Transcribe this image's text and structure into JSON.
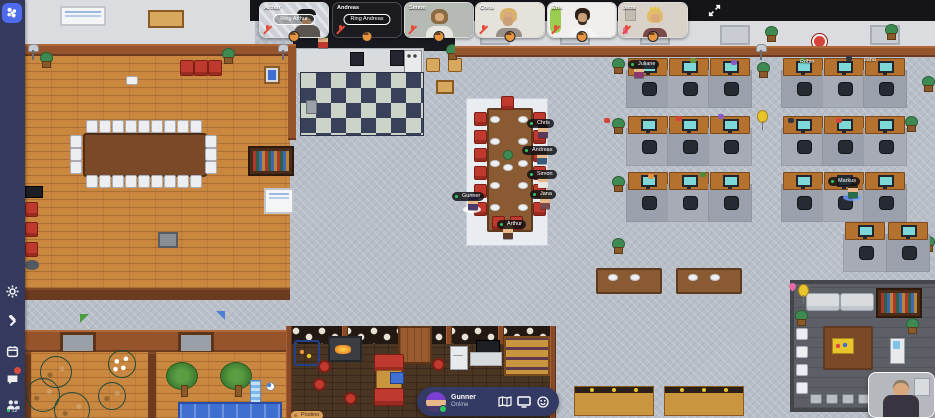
{
  "app": {
    "title": "Gather"
  },
  "sidebar": {
    "members_count": "12",
    "icons": [
      {
        "name": "settings"
      },
      {
        "name": "build"
      },
      {
        "name": "calendar"
      },
      {
        "name": "chat"
      },
      {
        "name": "members"
      }
    ]
  },
  "call": {
    "participants": [
      {
        "name": "Arthur",
        "ring_label": "Ring Arthur",
        "camera": "off",
        "muted": true
      },
      {
        "name": "Andreas",
        "ring_label": "Ring Andreas",
        "camera": "off",
        "muted": true
      },
      {
        "name": "Simon",
        "camera": "on",
        "muted": true
      },
      {
        "name": "Chris",
        "camera": "on",
        "muted": true
      },
      {
        "name": "Erik",
        "camera": "on",
        "muted": true
      },
      {
        "name": "Jana",
        "camera": "on",
        "muted": true
      }
    ]
  },
  "control_bar": {
    "user_name": "Gunner",
    "status": "Online"
  },
  "map_players": {
    "juliane": {
      "name": "Juliane"
    },
    "robin": {
      "name": "Robin"
    },
    "jana_desk": {
      "name": "Jana"
    },
    "markus": {
      "name": "Markus"
    },
    "chris": {
      "name": "Chris"
    },
    "andreas": {
      "name": "Andreas"
    },
    "simon": {
      "name": "Simon"
    },
    "jana": {
      "name": "Jana"
    },
    "gunner": {
      "name": "Gunner"
    },
    "arthur": {
      "name": "Arthur"
    },
    "postino": {
      "name": "Postino"
    }
  },
  "colors": {
    "accent_blue": "#4f6bed",
    "status_green": "#2ecc5e",
    "mic_red": "#e64c3c",
    "sidebar_bg": "#343a5e",
    "map_bg": "#b9bfc8"
  }
}
